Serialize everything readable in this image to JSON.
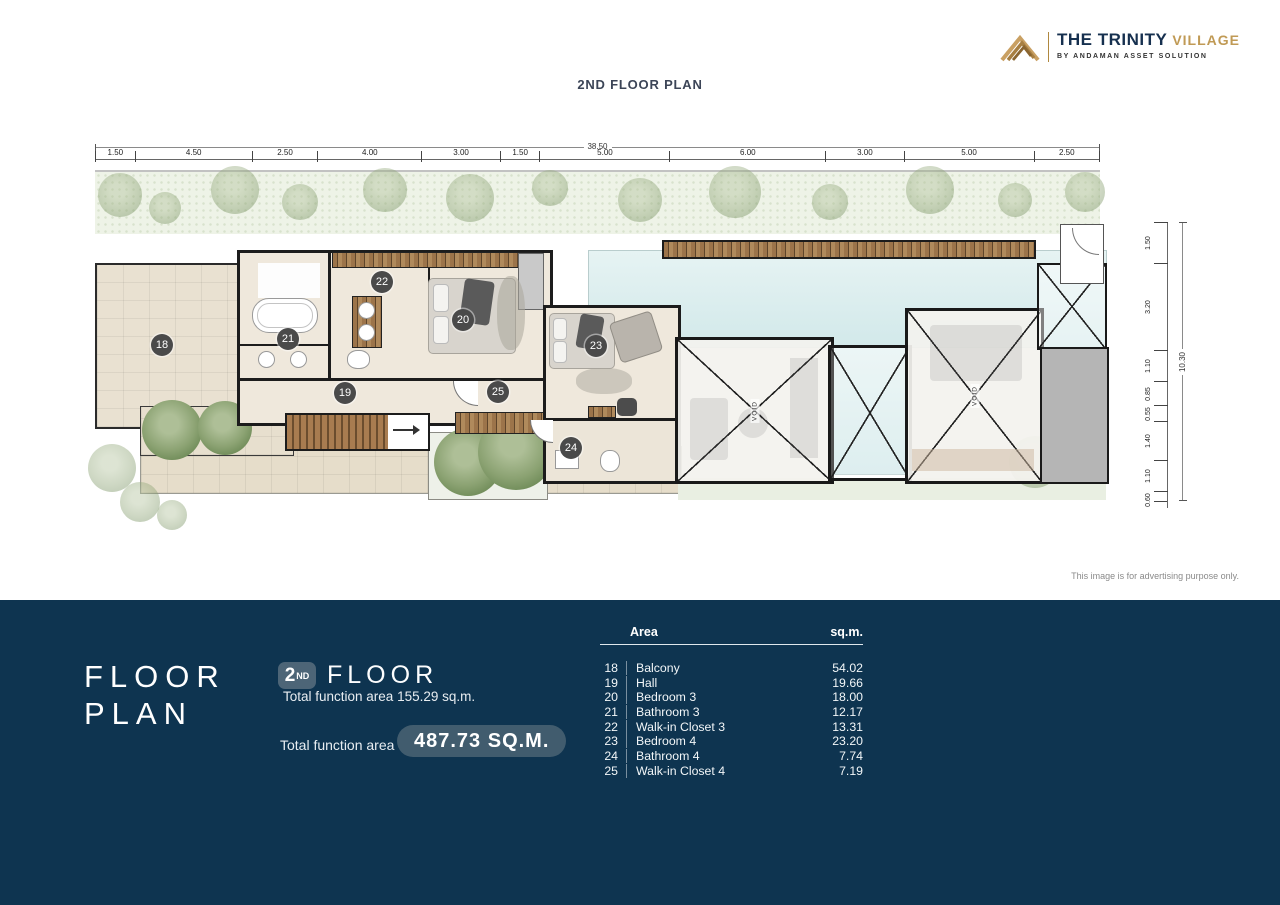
{
  "brand": {
    "name": "THE TRINITY",
    "suffix": "VILLAGE",
    "tagline": "BY ANDAMAN ASSET SOLUTION"
  },
  "page_title": "2ND FLOOR PLAN",
  "disclaimer": "This image is for advertising purpose only.",
  "plan": {
    "total_width_m": "38.50",
    "total_height_m": "10.30",
    "top_dimensions": [
      "1.50",
      "4.50",
      "2.50",
      "4.00",
      "3.00",
      "1.50",
      "5.00",
      "6.00",
      "3.00",
      "5.00",
      "2.50"
    ],
    "right_dimensions": [
      "1.50",
      "3.20",
      "1.10",
      "0.85",
      "0.55",
      "1.40",
      "1.10",
      "0.60"
    ],
    "void_label": "VOID"
  },
  "footer": {
    "heading_line1": "FLOOR",
    "heading_line2": "PLAN",
    "floor_number": "2",
    "floor_ordinal": "ND",
    "floor_word": "FLOOR",
    "floor_area_note": "Total function area 155.29 sq.m.",
    "total_area_label": "Total function area",
    "total_area_value": "487.73 SQ.M.",
    "table": {
      "col_area": "Area",
      "col_unit": "sq.m.",
      "rows": [
        {
          "no": "18",
          "name": "Balcony",
          "sqm": "54.02"
        },
        {
          "no": "19",
          "name": "Hall",
          "sqm": "19.66"
        },
        {
          "no": "20",
          "name": "Bedroom 3",
          "sqm": "18.00"
        },
        {
          "no": "21",
          "name": "Bathroom 3",
          "sqm": "12.17"
        },
        {
          "no": "22",
          "name": "Walk-in Closet 3",
          "sqm": "13.31"
        },
        {
          "no": "23",
          "name": "Bedroom 4",
          "sqm": "23.20"
        },
        {
          "no": "24",
          "name": "Bathroom 4",
          "sqm": "7.74"
        },
        {
          "no": "25",
          "name": "Walk-in Closet 4",
          "sqm": "7.19"
        }
      ]
    }
  },
  "colors": {
    "footer_bg": "#0e3450",
    "badge_bg": "#4d6577",
    "pill_bg": "#415c6e",
    "brand_navy": "#16304f",
    "brand_gold": "#c09a55",
    "pool": "#d7ecee",
    "wall": "#1c1c1c",
    "floor_beige": "#e9e1d1",
    "tree_green": "#8ba272"
  }
}
